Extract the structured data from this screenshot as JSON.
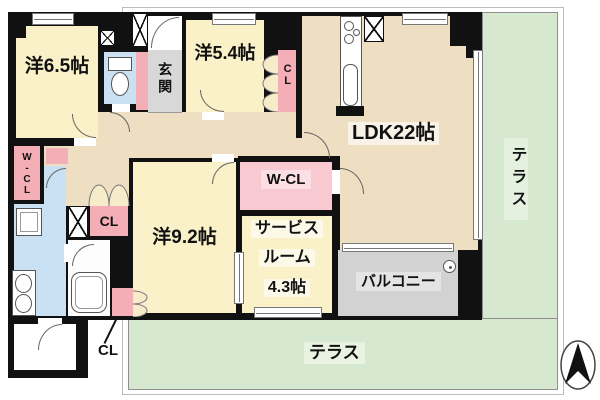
{
  "plan_title": "apartment-floor-plan",
  "rooms": {
    "west65": {
      "label": "洋6.5帖"
    },
    "west54": {
      "label": "洋5.4帖"
    },
    "west92": {
      "label": "洋9.2帖"
    },
    "ldk": {
      "label": "LDK22帖"
    },
    "genkan": {
      "label": "玄関"
    },
    "service": {
      "lines": [
        "サービス",
        "ルーム",
        "4.3帖"
      ]
    },
    "wcl_center": {
      "label": "W-CL"
    },
    "wcl_left": {
      "label": "W-CL"
    },
    "cl_hall": {
      "label": "CL"
    },
    "cl_west54": {
      "label": "CL"
    },
    "cl_west92": {
      "label": "CL"
    }
  },
  "outdoor": {
    "balcony": {
      "label": "バルコニー"
    },
    "terrace_right": {
      "label": "テラス"
    },
    "terrace_bottom": {
      "label": "テラス"
    }
  },
  "icons": {
    "compass": "north-arrow",
    "toilet": "toilet",
    "bathtub": "bathtub",
    "kitchen": "kitchen-counter-with-stove-and-sink",
    "washer": "washing-machine",
    "vanity": "double-basin-washstand",
    "drain": "balcony-drain",
    "shaft": "pipe-shaft-x-box",
    "window": "window",
    "door_arc": "door-swing",
    "folding_door": "folding-closet-door"
  },
  "colors": {
    "wall": "#111111",
    "room_cream": "#FAF1C9",
    "room_tan": "#EFDFC2",
    "closet_pink": "#F4AFB6",
    "closet_pink_light": "#FBDFE4",
    "wet_area_blue": "#C9E1F3",
    "genkan_gray": "#D8D8D8",
    "balcony_gray": "#D2D2D2",
    "terrace_green": "#D6E8CF"
  }
}
